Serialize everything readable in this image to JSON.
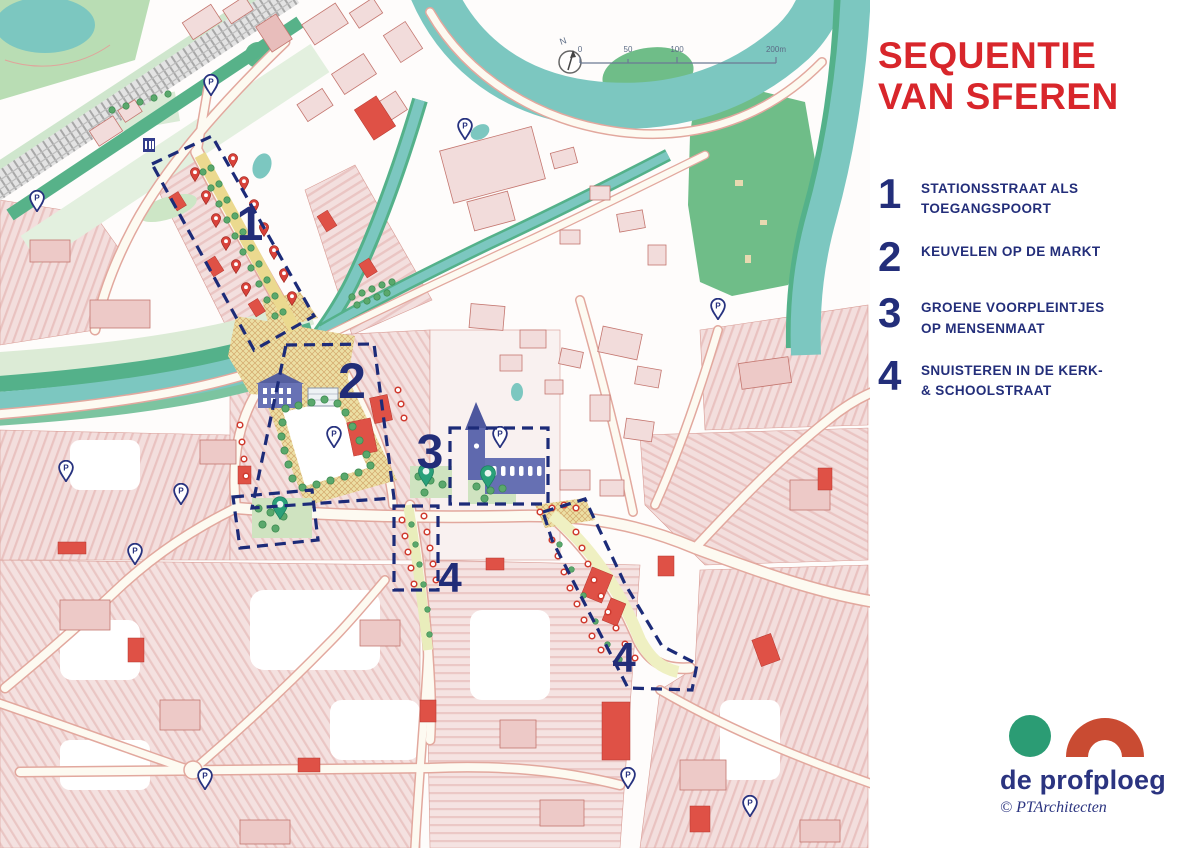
{
  "title": {
    "line1": "SEQUENTIE",
    "line2": "VAN SFEREN"
  },
  "legend": {
    "items": [
      {
        "num": "1",
        "line1": "STATIONSSTRAAT ALS",
        "line2": "TOEGANGSPOORT"
      },
      {
        "num": "2",
        "line1": "KEUVELEN OP DE MARKT",
        "line2": ""
      },
      {
        "num": "3",
        "line1": "GROENE VOORPLEINTJES",
        "line2": "OP MENSENMAAT"
      },
      {
        "num": "4",
        "line1": "SNUISTEREN IN DE KERK-",
        "line2": "& SCHOOLSTRAAT"
      }
    ]
  },
  "map": {
    "zone_labels": {
      "1": "1",
      "2": "2",
      "3": "3",
      "4": "4"
    },
    "scale": {
      "t0": "0",
      "t50": "50",
      "t100": "100",
      "t200": "200m"
    },
    "north": "N",
    "pin_letter": "P"
  },
  "logo": {
    "name": "de profploeg",
    "copyright": "© PTArchitecten"
  },
  "colors": {
    "title_red": "#d8262b",
    "navy": "#232e7a",
    "water_teal": "#7cc7c0",
    "bank_green": "#54b18a",
    "park_green": "#6fbd88",
    "building_pink": "#f2dcdb",
    "accent_red": "#df5146",
    "plaza_yellow": "#ecdfa4",
    "logo_green": "#2b9c74",
    "logo_red": "#c94b32"
  }
}
